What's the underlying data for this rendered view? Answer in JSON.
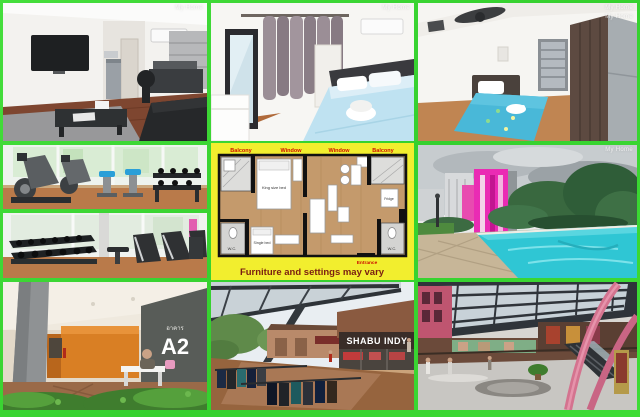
{
  "colors": {
    "frame_green": "#3ed336",
    "plan_yellow": "#f2ee2e",
    "caption_maroon": "#7a1d12",
    "label_red": "#cc1100",
    "pool_turquoise": "#2fc6d4",
    "pink_building": "#ea2bb4",
    "lobby_orange": "#d98125",
    "sign_gray": "#585c58"
  },
  "watermark": {
    "text": "My Home"
  },
  "floor_plan": {
    "caption": "Furniture and settings may vary",
    "labels": {
      "balcony_left": "Balcony",
      "window_left": "Window",
      "window_right": "Window",
      "balcony_right": "Balcony",
      "king_bed": "King size bed",
      "single_bed": "Single bed",
      "wc_left": "W.C.",
      "wc_right": "W.C.",
      "fridge": "Fridge",
      "entrance": "Entrance"
    }
  },
  "signs": {
    "building_label_thai": "อาคาร",
    "building_code": "A2",
    "restaurant_name": "SHABU INDY"
  }
}
